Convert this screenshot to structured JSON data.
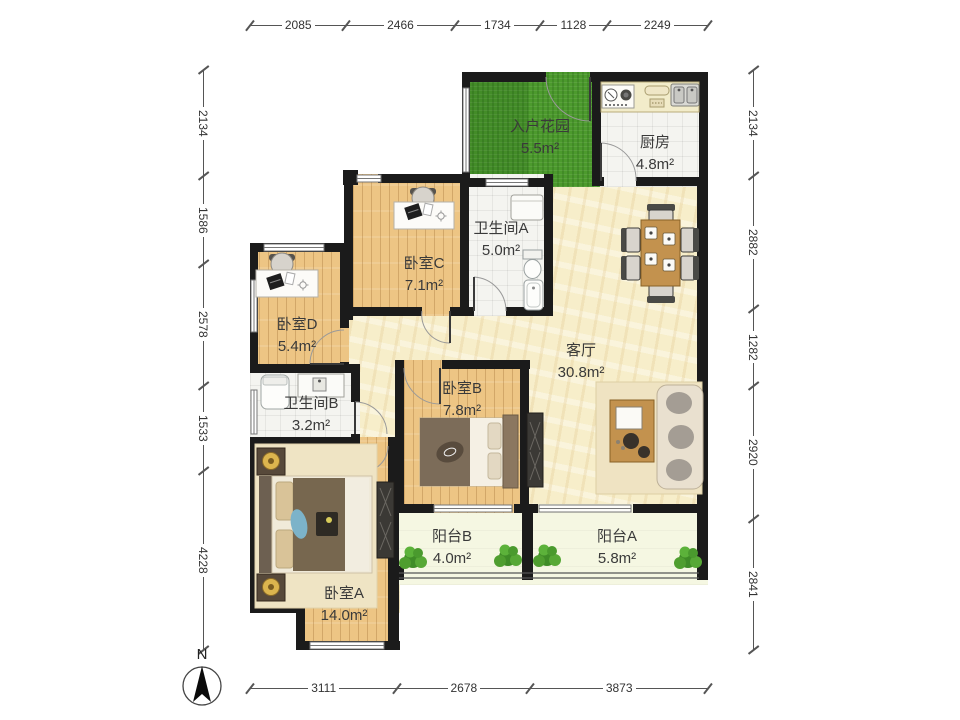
{
  "plan": {
    "rooms": {
      "garden": {
        "label": "入户花园",
        "area": "5.5m²"
      },
      "kitchen": {
        "label": "厨房",
        "area": "4.8m²"
      },
      "bedroom_c": {
        "label": "卧室C",
        "area": "7.1m²"
      },
      "bath_a": {
        "label": "卫生间A",
        "area": "5.0m²"
      },
      "bedroom_d": {
        "label": "卧室D",
        "area": "5.4m²"
      },
      "living": {
        "label": "客厅",
        "area": "30.8m²"
      },
      "bath_b": {
        "label": "卫生间B",
        "area": "3.2m²"
      },
      "bedroom_b": {
        "label": "卧室B",
        "area": "7.8m²"
      },
      "bedroom_a": {
        "label": "卧室A",
        "area": "14.0m²"
      },
      "balcony_b": {
        "label": "阳台B",
        "area": "4.0m²"
      },
      "balcony_a": {
        "label": "阳台A",
        "area": "5.8m²"
      }
    },
    "compass": {
      "label": "N"
    }
  },
  "dimensions": {
    "top": [
      "2085",
      "2466",
      "1734",
      "1128",
      "2249"
    ],
    "bottom": [
      "3111",
      "2678",
      "3873"
    ],
    "left": [
      "2134",
      "1586",
      "2578",
      "1533",
      "4228"
    ],
    "right": [
      "2134",
      "2882",
      "1282",
      "2920",
      "2841"
    ]
  },
  "colors": {
    "wall": "#1b1b1b",
    "wood": "#edc584",
    "living_floor": "#f7eeca",
    "tile": "#f4f4f0",
    "grass": "#4c9a2d",
    "balcony": "#f5f7e2",
    "furniture_wood": "#c3924e",
    "label_text": "#3a3a3a",
    "dim_text": "#333333"
  }
}
